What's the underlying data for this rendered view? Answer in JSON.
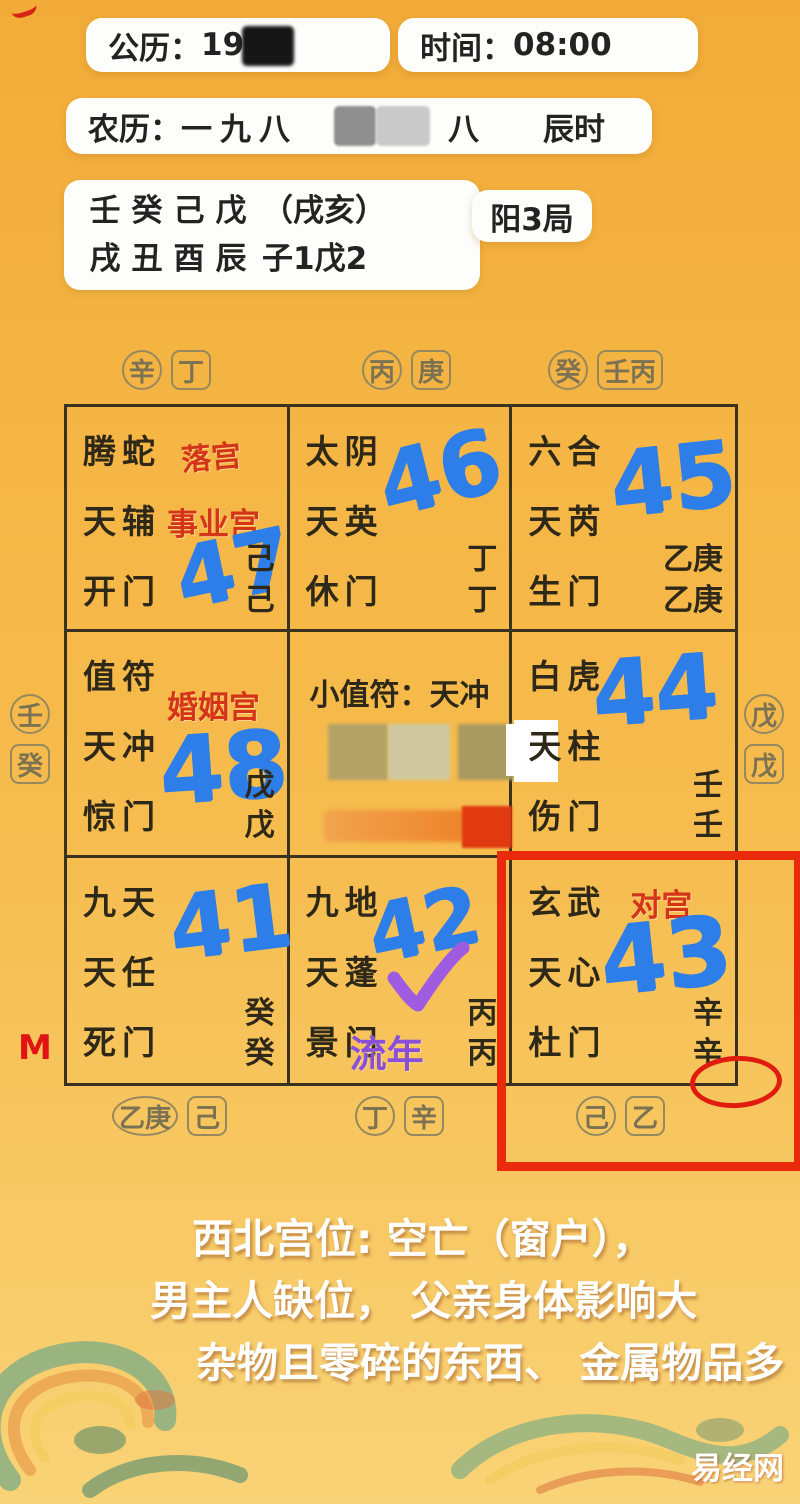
{
  "header": {
    "solar_label": "公历：",
    "solar_value": "198",
    "time_label": "时间：",
    "time_value": "08:00",
    "lunar_label": "农历：",
    "lunar_prefix": "一九八",
    "lunar_suffix": "八",
    "lunar_hour": "辰时",
    "bazi_row1": [
      "壬",
      "癸",
      "己",
      "戊",
      "（戌亥）"
    ],
    "bazi_row2": [
      "戌",
      "丑",
      "酉",
      "辰",
      "子1戊2"
    ],
    "ju_label": "阳3局"
  },
  "outer_stems": {
    "top": [
      {
        "circle": "辛",
        "square": "丁"
      },
      {
        "circle": "丙",
        "square": "庚"
      },
      {
        "circle": "癸",
        "square": "壬丙"
      }
    ],
    "left": {
      "circle": "壬",
      "square": "癸"
    },
    "right": {
      "circle": "戊",
      "square": "戊"
    },
    "bottom": [
      {
        "circle": "乙庚",
        "square": "己"
      },
      {
        "circle": "丁",
        "square": "辛"
      },
      {
        "circle": "己",
        "square": "乙"
      }
    ]
  },
  "grid": {
    "center_title": "小值符：天冲",
    "cells": [
      {
        "lines": [
          "腾蛇",
          "天辅",
          "开门"
        ],
        "red_label_1": "落宫",
        "red_label_2": "事业宫",
        "number": "47",
        "stems": [
          "己",
          "己"
        ]
      },
      {
        "lines": [
          "太阴",
          "天英",
          "休门"
        ],
        "number": "46",
        "stems": [
          "丁",
          "丁"
        ]
      },
      {
        "lines": [
          "六合",
          "天芮",
          "生门"
        ],
        "number": "45",
        "stems": [
          "乙庚",
          "乙庚"
        ]
      },
      {
        "lines": [
          "值符",
          "天冲",
          "惊门"
        ],
        "red_label_1": "婚姻宫",
        "number": "48",
        "stems": [
          "戊",
          "戊"
        ]
      },
      {
        "lines": [
          "白虎",
          "天柱",
          "伤门"
        ],
        "number": "44",
        "stems": [
          "壬",
          "壬"
        ]
      },
      {
        "lines": [
          "九天",
          "天任",
          "死门"
        ],
        "number": "41",
        "stems": [
          "癸",
          "癸"
        ]
      },
      {
        "lines": [
          "九地",
          "天蓬",
          "景门"
        ],
        "number": "42",
        "stems": [
          "丙",
          "丙"
        ],
        "purple_label": "流年"
      },
      {
        "lines": [
          "玄武",
          "天心",
          "杜门"
        ],
        "red_label_1": "对宫",
        "number": "43",
        "stems": [
          "辛",
          "辛"
        ]
      }
    ]
  },
  "annotations": {
    "m_marker": "M"
  },
  "footer": {
    "lines": [
      "西北宫位: 空亡（窗户），",
      "男主人缺位， 父亲身体影响大",
      "杂物且零碎的东西、 金属物品多"
    ],
    "watermark": "易经网"
  },
  "colors": {
    "handwriting_blue": "#2d7ee8",
    "annotation_red": "#d43417",
    "highlight_red": "#ea2a0c",
    "purple": "#8a4fd8",
    "background_yellow": "#f5b645"
  }
}
